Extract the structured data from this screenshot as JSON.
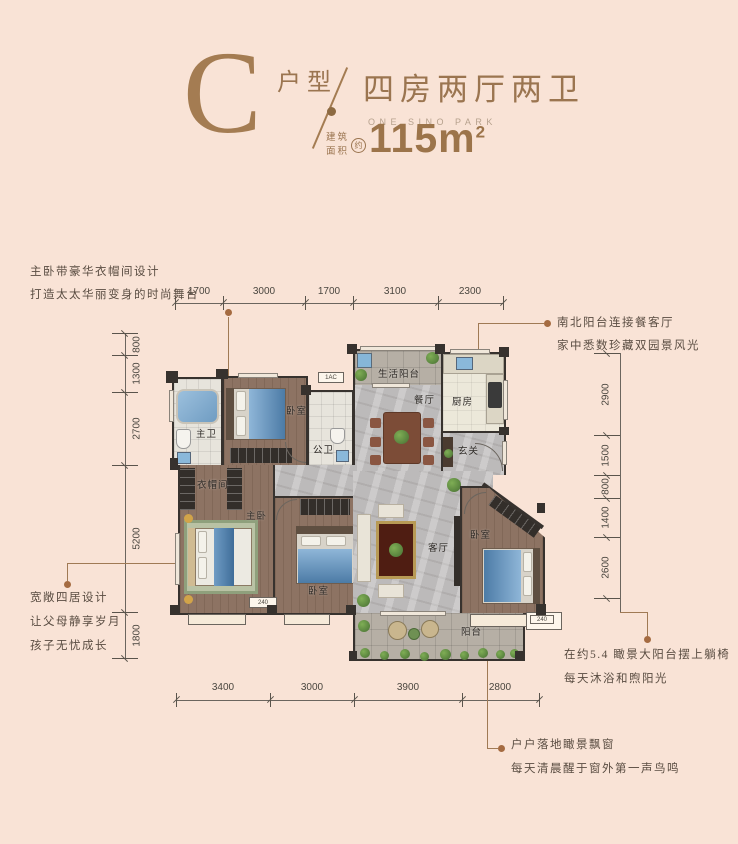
{
  "header": {
    "type_letter": "C",
    "type_label": "户型",
    "layout_title": "四房两厅两卫",
    "subtitle_en": "ONE SINO PARK",
    "area_prefix_line1": "建筑",
    "area_prefix_line2": "面积",
    "area_approx": "约",
    "area_value": "115m",
    "area_sup": "2"
  },
  "dimensions": {
    "top": [
      "1700",
      "3000",
      "1700",
      "3100",
      "2300"
    ],
    "bottom": [
      "3400",
      "3000",
      "3900",
      "2800"
    ],
    "left": [
      "800",
      "1300",
      "2700",
      "5200",
      "1800"
    ],
    "right": [
      "2900",
      "1500",
      "800",
      "1400",
      "2600"
    ]
  },
  "annotations": {
    "top_left": [
      "主卧带豪华衣帽间设计",
      "打造太太华丽变身的时尚舞台"
    ],
    "top_right": [
      "南北阳台连接餐客厅",
      "家中悉数珍藏双园景风光"
    ],
    "bottom_left": [
      "宽敞四居设计",
      "让父母静享岁月",
      "孩子无忧成长"
    ],
    "bottom_right": [
      "在约5.4 瞰景大阳台摆上躺椅",
      "每天沐浴和煦阳光"
    ],
    "bottom_center": [
      "户户落地瞰景飘窗",
      "每天清晨醒于窗外第一声鸟鸣"
    ]
  },
  "rooms": {
    "service_balcony": "生活阳台",
    "kitchen": "厨房",
    "dining": "餐厅",
    "foyer": "玄关",
    "master_bath": "主卫",
    "bedroom_top": "卧室",
    "public_bath": "公卫",
    "closet": "衣帽间",
    "master_bedroom": "主卧",
    "bedroom_mid": "卧室",
    "living": "客厅",
    "bedroom_right": "卧室",
    "balcony": "阳台"
  },
  "plan_labels": {
    "ac_top": "1AC",
    "ac_mid": "240",
    "ac_right": "240"
  },
  "colors": {
    "background": "#f9e3d6",
    "brand_brown": "#a0794f",
    "wall": "#37322e",
    "leader_dot": "#a56b41",
    "bed_blue": "#5e8cb4",
    "marble_gray": "#bcbaba",
    "wood_brown": "#8d7363"
  }
}
